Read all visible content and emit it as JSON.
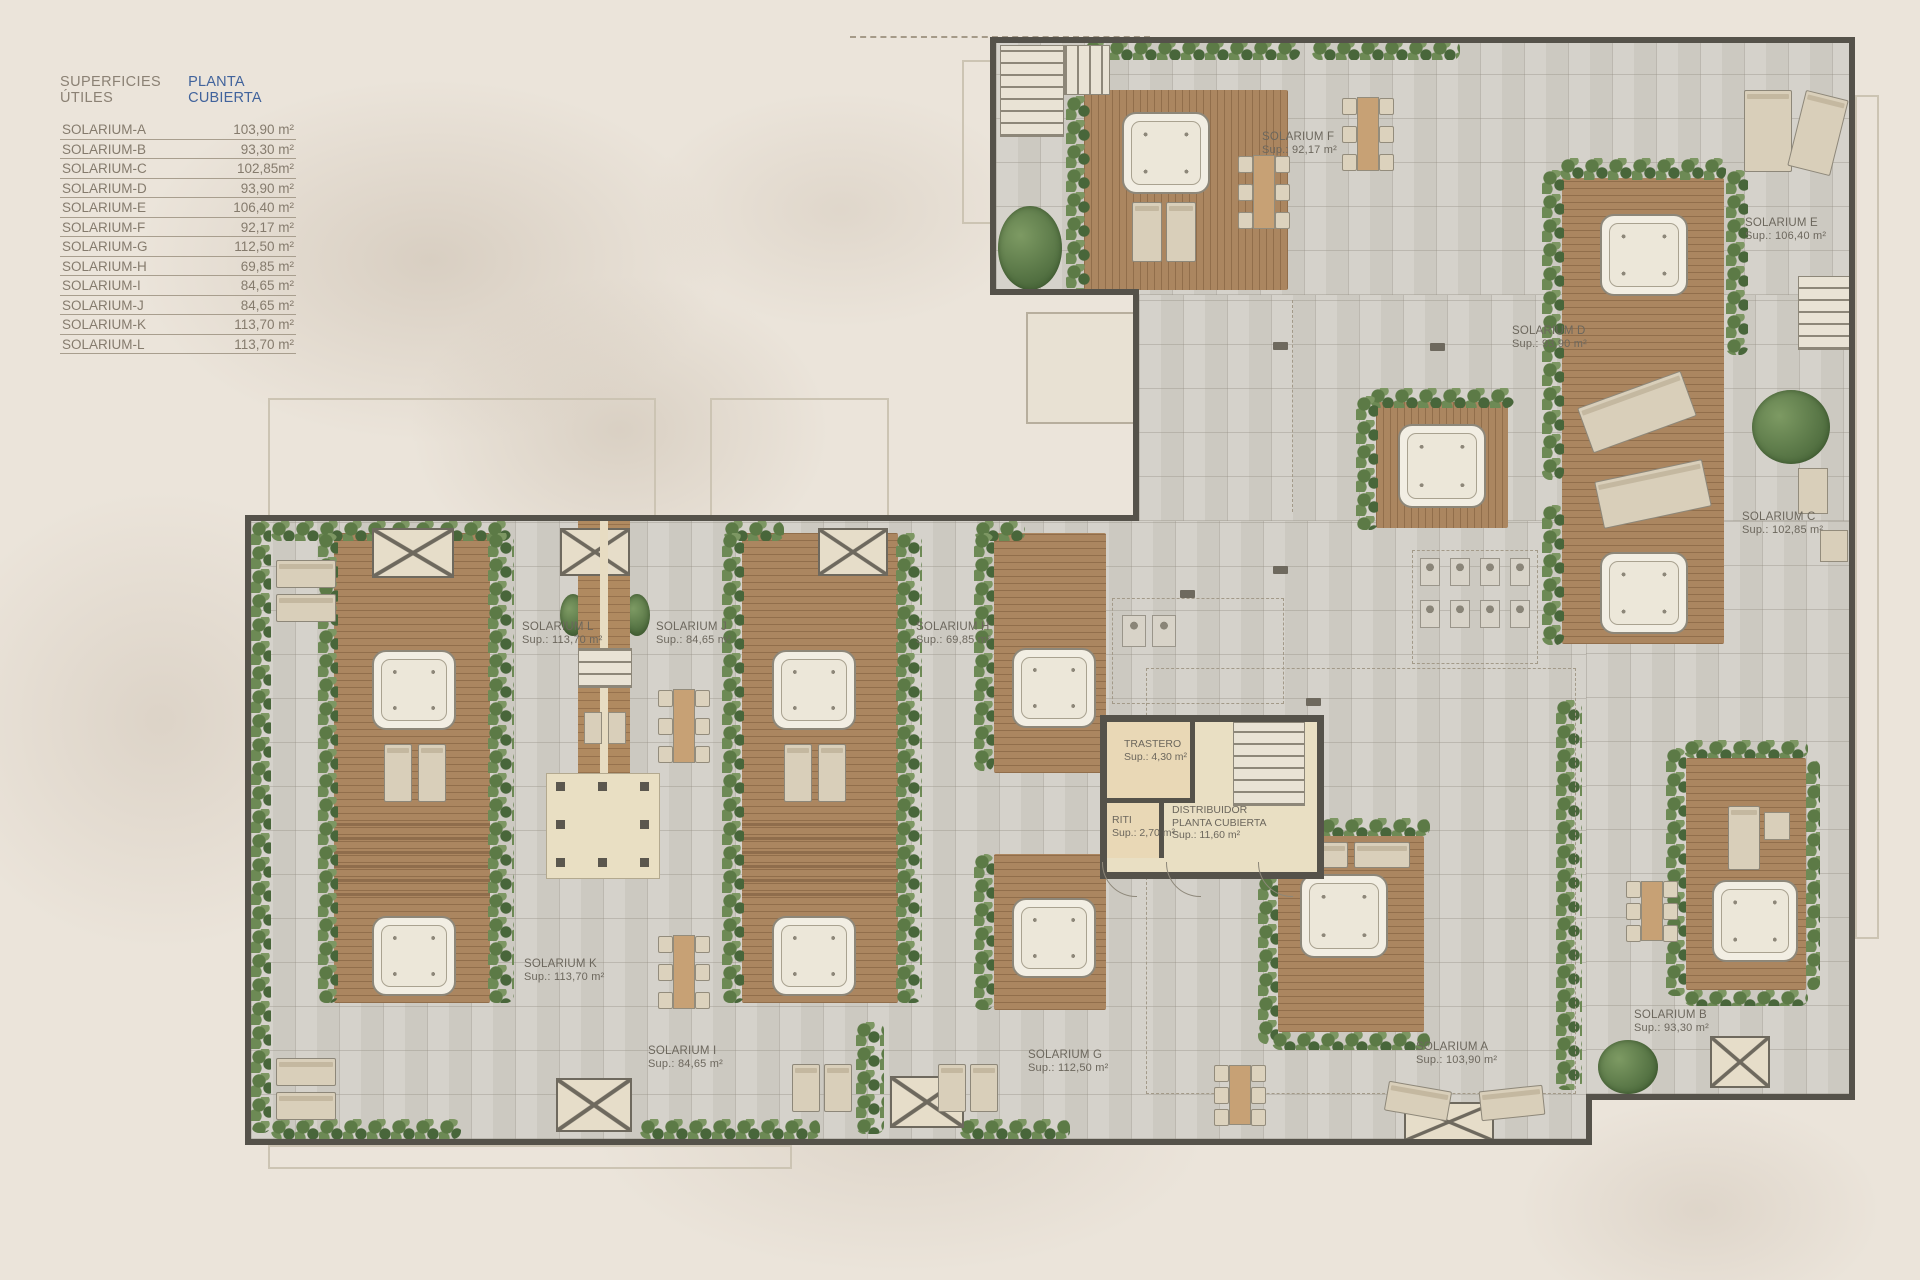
{
  "legend": {
    "title_left": "SUPERFICIES ÚTILES",
    "title_right": "PLANTA CUBIERTA",
    "rows": [
      {
        "label": "SOLARIUM-A",
        "value": "103,90 m²"
      },
      {
        "label": "SOLARIUM-B",
        "value": "93,30 m²"
      },
      {
        "label": "SOLARIUM-C",
        "value": "102,85m²"
      },
      {
        "label": "SOLARIUM-D",
        "value": "93,90 m²"
      },
      {
        "label": "SOLARIUM-E",
        "value": "106,40 m²"
      },
      {
        "label": "SOLARIUM-F",
        "value": "92,17 m²"
      },
      {
        "label": "SOLARIUM-G",
        "value": "112,50 m²"
      },
      {
        "label": "SOLARIUM-H",
        "value": "69,85 m²"
      },
      {
        "label": "SOLARIUM-I",
        "value": "84,65 m²"
      },
      {
        "label": "SOLARIUM-J",
        "value": "84,65 m²"
      },
      {
        "label": "SOLARIUM-K",
        "value": "113,70 m²"
      },
      {
        "label": "SOLARIUM-L",
        "value": "113,70 m²"
      }
    ]
  },
  "plan": {
    "rooms": [
      {
        "id": "F",
        "name": "SOLARIUM F",
        "sup": "Sup.: 92,17 m²"
      },
      {
        "id": "E",
        "name": "SOLARIUM E",
        "sup": "Sup.: 106,40 m²"
      },
      {
        "id": "D",
        "name": "SOLARIUM D",
        "sup": "Sup.: 93,90 m²"
      },
      {
        "id": "C",
        "name": "SOLARIUM C",
        "sup": "Sup.: 102,85 m²"
      },
      {
        "id": "L",
        "name": "SOLARIUM L",
        "sup": "Sup.: 113,70 m²"
      },
      {
        "id": "J",
        "name": "SOLARIUM J",
        "sup": "Sup.: 84,65 m²"
      },
      {
        "id": "H",
        "name": "SOLARIUM H",
        "sup": "Sup.: 69,85 m²"
      },
      {
        "id": "K",
        "name": "SOLARIUM K",
        "sup": "Sup.: 113,70 m²"
      },
      {
        "id": "I",
        "name": "SOLARIUM I",
        "sup": "Sup.: 84,65 m²"
      },
      {
        "id": "G",
        "name": "SOLARIUM G",
        "sup": "Sup.: 112,50 m²"
      },
      {
        "id": "A",
        "name": "SOLARIUM A",
        "sup": "Sup.: 103,90 m²"
      },
      {
        "id": "B",
        "name": "SOLARIUM B",
        "sup": "Sup.: 93,30 m²"
      }
    ],
    "core": {
      "trastero": {
        "name": "TRASTERO",
        "sup": "Sup.: 4,30 m²"
      },
      "riti": {
        "name": "RITI",
        "sup": "Sup.: 2,70 m²"
      },
      "distribuidor": {
        "line1": "DISTRIBUIDOR",
        "line2": "PLANTA CUBIERTA",
        "sup": "Sup.: 11,60 m²"
      }
    }
  },
  "colors": {
    "background": "#ebe4da",
    "tile_floor": "#d3d0c8",
    "wood_deck": "#ab8660",
    "hedge_green": "#5c7a46",
    "wall": "#55524a",
    "corridor": "#e9dfc3",
    "legend_accent_blue": "#41639c",
    "label_text": "#6c675d"
  }
}
